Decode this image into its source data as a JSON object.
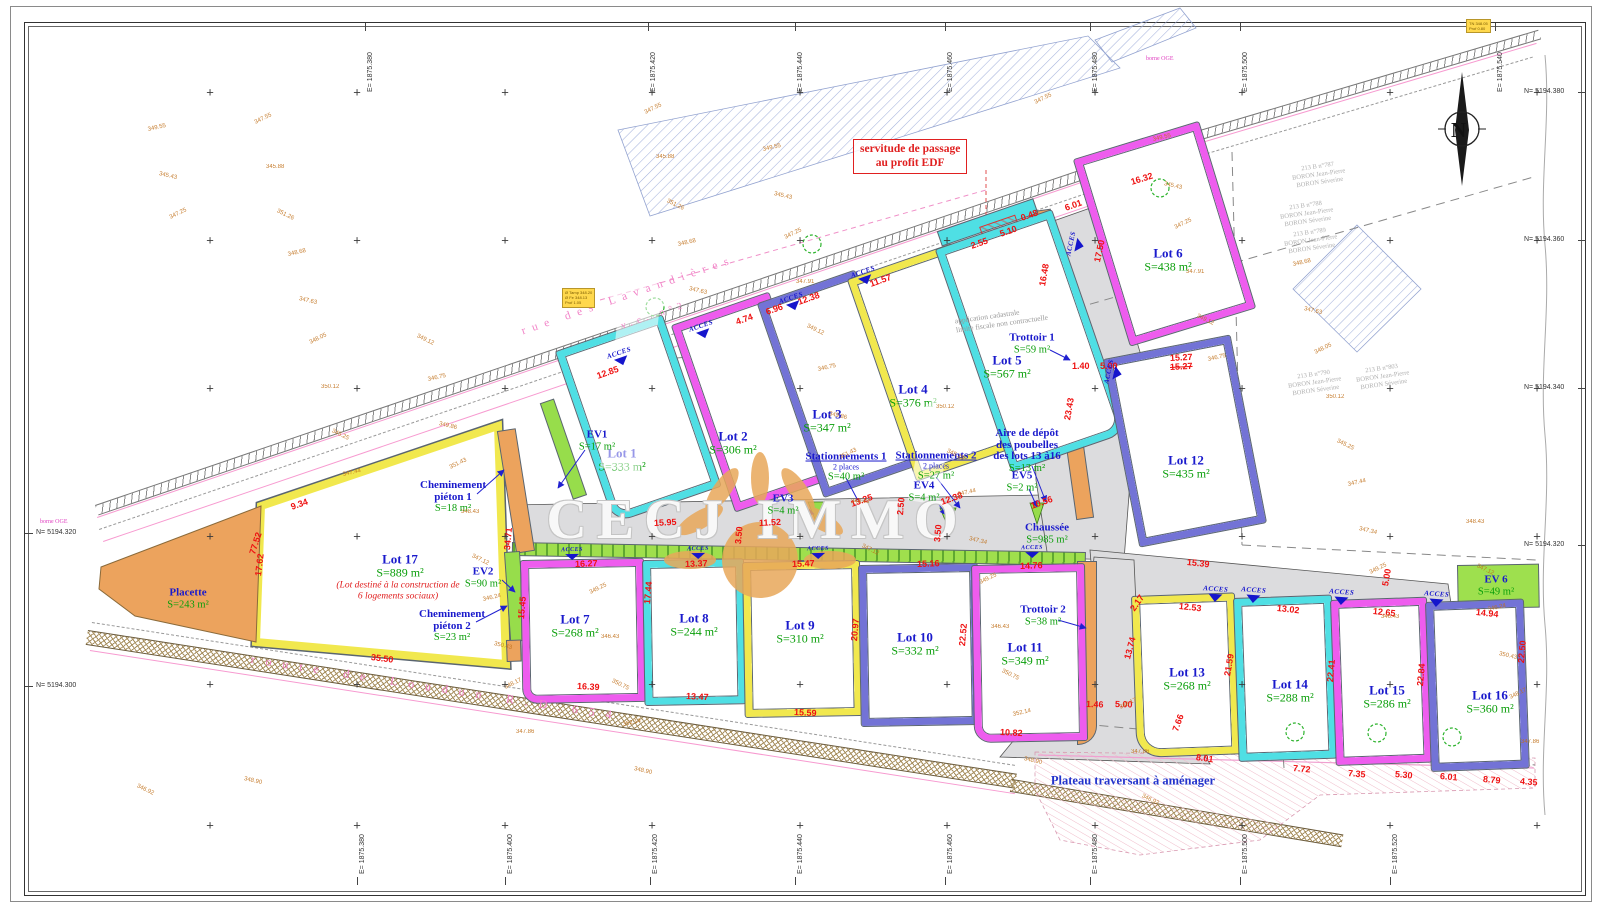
{
  "watermark": "CECJ IMMO",
  "north_letter": "N",
  "colors": {
    "cyan": "#4fdfe4",
    "magenta": "#ee5cee",
    "yellow": "#f1e84e",
    "purple": "#7373d6",
    "green": "#97dd4b",
    "orange": "#eca35d"
  },
  "streets": {
    "top_name": "rue des Lavandières",
    "top_ref": "v.c. n°2",
    "bottom": "route de Loudun R.D.654"
  },
  "annotations": {
    "servitude_l1": "servitude de passage",
    "servitude_l2": "au profit EDF",
    "plateau": "Plateau traversant à aménager",
    "cadastre_l1": "application cadastrale",
    "cadastre_l2": "limite fiscale non contractuelle",
    "borne": "borne OGE",
    "acces": "ACCES",
    "manhole_l1": "Ø Tamp 348.20",
    "manhole_l2": "Ø Fe 348.13",
    "manhole_l3": "Prof 1.05",
    "tn_l1": "TN 348.05",
    "tn_l2": "Prof 0.80"
  },
  "lots": [
    {
      "name": "Lot 1",
      "area": "S=333 m²",
      "c": "cyan",
      "x": 556,
      "y": 352,
      "w": 112,
      "h": 180,
      "r": -19,
      "lx": 622,
      "ly": 460,
      "rad": "2px 2px 2px 18px"
    },
    {
      "name": "Lot 2",
      "area": "S=306 m²",
      "c": "magenta",
      "x": 672,
      "y": 326,
      "w": 102,
      "h": 196,
      "r": -19,
      "lx": 733,
      "ly": 443,
      "rad": "2px"
    },
    {
      "name": "Lot 3",
      "area": "S=347 m²",
      "c": "purple",
      "x": 758,
      "y": 304,
      "w": 102,
      "h": 204,
      "r": -19,
      "lx": 827,
      "ly": 421,
      "rad": "2px"
    },
    {
      "name": "Lot 4",
      "area": "S=376 m²",
      "c": "yellow",
      "x": 848,
      "y": 280,
      "w": 110,
      "h": 212,
      "r": -19,
      "lx": 913,
      "ly": 396,
      "rad": "2px"
    },
    {
      "name": "Lot 5",
      "area": "S=567 m²",
      "c": "cyan",
      "x": 936,
      "y": 250,
      "w": 122,
      "h": 234,
      "r": -19,
      "lx": 1007,
      "ly": 367,
      "rad": "2px 2px 20px 2px"
    },
    {
      "name": "Lot 6",
      "area": "S=438 m²",
      "c": "magenta",
      "x": 1074,
      "y": 160,
      "w": 130,
      "h": 194,
      "r": -17,
      "lx": 1168,
      "ly": 260,
      "rad": "2px"
    },
    {
      "name": "Lot 7",
      "area": "S=268 m²",
      "c": "magenta",
      "x": 521,
      "y": 561,
      "w": 122,
      "h": 142,
      "r": -1,
      "lx": 575,
      "ly": 626,
      "rad": "2px 2px 2px 14px"
    },
    {
      "name": "Lot 8",
      "area": "S=244 m²",
      "c": "cyan",
      "x": 643,
      "y": 561,
      "w": 100,
      "h": 144,
      "r": -1,
      "lx": 694,
      "ly": 625,
      "rad": "2px"
    },
    {
      "name": "Lot 9",
      "area": "S=310 m²",
      "c": "yellow",
      "x": 743,
      "y": 563,
      "w": 116,
      "h": 154,
      "r": -1,
      "lx": 800,
      "ly": 632,
      "rad": "2px"
    },
    {
      "name": "Lot 10",
      "area": "S=332 m²",
      "c": "purple",
      "x": 859,
      "y": 566,
      "w": 118,
      "h": 160,
      "r": -1,
      "lx": 915,
      "ly": 644,
      "rad": "2px"
    },
    {
      "name": "Lot 11",
      "area": "S=349 m²",
      "c": "magenta",
      "x": 972,
      "y": 566,
      "w": 112,
      "h": 176,
      "r": -1,
      "lx": 1025,
      "ly": 654,
      "rad": "2px 2px 2px 16px"
    },
    {
      "name": "Lot 12",
      "area": "S=435 m²",
      "c": "purple",
      "x": 1104,
      "y": 360,
      "w": 128,
      "h": 190,
      "r": -11,
      "lx": 1186,
      "ly": 467,
      "rad": "2px"
    },
    {
      "name": "Lot 13",
      "area": "S=268 m²",
      "c": "yellow",
      "x": 1132,
      "y": 597,
      "w": 102,
      "h": 160,
      "r": -2,
      "lx": 1187,
      "ly": 679,
      "rad": "2px 2px 2px 24px"
    },
    {
      "name": "Lot 14",
      "area": "S=288 m²",
      "c": "cyan",
      "x": 1234,
      "y": 599,
      "w": 97,
      "h": 162,
      "r": -2,
      "lx": 1290,
      "ly": 691,
      "rad": "2px"
    },
    {
      "name": "Lot 15",
      "area": "S=286 m²",
      "c": "magenta",
      "x": 1331,
      "y": 601,
      "w": 95,
      "h": 164,
      "r": -2,
      "lx": 1387,
      "ly": 697,
      "rad": "2px"
    },
    {
      "name": "Lot 16",
      "area": "S=360 m²",
      "c": "purple",
      "x": 1426,
      "y": 603,
      "w": 97,
      "h": 168,
      "r": -2,
      "lx": 1490,
      "ly": 702,
      "rad": "2px"
    }
  ],
  "lot17": {
    "name": "Lot 17",
    "area": "S=889 m²",
    "sub1": "(Lot destiné à la construction de",
    "sub2": "6 logements sociaux)",
    "points": "261,506 498,426 506,664 256,642",
    "lx": 400,
    "ly": 566
  },
  "placette": {
    "points": "101,567 261,506 256,642 135,616 99,589"
  },
  "features": [
    {
      "lines": [
        "Placette"
      ],
      "area": "S=243 m²",
      "x": 188,
      "y": 599
    },
    {
      "lines": [
        "EV1"
      ],
      "area": "S=17 m²",
      "x": 597,
      "y": 441
    },
    {
      "lines": [
        "EV2"
      ],
      "area": "S=90 m²",
      "x": 483,
      "y": 578
    },
    {
      "lines": [
        "EV3"
      ],
      "area": "S=4 m²",
      "x": 783,
      "y": 505
    },
    {
      "lines": [
        "EV4"
      ],
      "area": "S=4 m²",
      "x": 924,
      "y": 492
    },
    {
      "lines": [
        "EV5"
      ],
      "area": "S=2 m²",
      "x": 1022,
      "y": 482
    },
    {
      "lines": [
        "EV 6"
      ],
      "area": "S=49 m²",
      "x": 1496,
      "y": 586
    },
    {
      "lines": [
        "Cheminement",
        "piéton 1"
      ],
      "area": "S=18 m²",
      "x": 453,
      "y": 497
    },
    {
      "lines": [
        "Cheminement",
        "piéton 2"
      ],
      "area": "S=23 m²",
      "x": 452,
      "y": 626
    },
    {
      "lines": [
        "Trottoir 1"
      ],
      "area": "S=59 m²",
      "x": 1032,
      "y": 344
    },
    {
      "lines": [
        "Trottoir 2"
      ],
      "area": "S=38 m²",
      "x": 1043,
      "y": 616
    },
    {
      "lines": [
        "Stationnements 1"
      ],
      "sub": "2 places",
      "area": "S=40 m²",
      "x": 846,
      "y": 467,
      "ul": true
    },
    {
      "lines": [
        "Stationnements 2"
      ],
      "sub": "2 places",
      "area": "S=27 m²",
      "x": 936,
      "y": 466,
      "ul": true
    },
    {
      "lines": [
        "Aire de dépôt",
        "des poubelles",
        "des lots 13 à16"
      ],
      "area": "S=13 m²",
      "x": 1027,
      "y": 451
    },
    {
      "lines": [
        "Chaussée"
      ],
      "area": "S=985 m²",
      "x": 1047,
      "y": 534
    }
  ],
  "dimensions": [
    [
      "12.85",
      597,
      371,
      -19
    ],
    [
      "9.34",
      291,
      502,
      -19
    ],
    [
      "4.74",
      736,
      317,
      -19
    ],
    [
      "6.96",
      766,
      307,
      -19
    ],
    [
      "12.38",
      798,
      297,
      -19
    ],
    [
      "11.57",
      870,
      279,
      -19
    ],
    [
      "16.32",
      1131,
      177,
      -17
    ],
    [
      "6.01",
      1065,
      203,
      -19
    ],
    [
      "0.48",
      1021,
      213,
      -19
    ],
    [
      "5.10",
      1000,
      229,
      -19
    ],
    [
      "2.55",
      971,
      241,
      -19
    ],
    [
      "15.95",
      654,
      518,
      -3
    ],
    [
      "11.52",
      759,
      518,
      -3
    ],
    [
      "13.25",
      851,
      499,
      -19
    ],
    [
      "12.38",
      941,
      497,
      -19
    ],
    [
      "10.56",
      1031,
      501,
      -19
    ],
    [
      "1.40",
      1072,
      361,
      0
    ],
    [
      "5.00",
      1100,
      361,
      0
    ],
    [
      "15.27",
      1170,
      353,
      -3
    ],
    [
      "15.27",
      1170,
      362,
      -3,
      1
    ],
    [
      "17.50",
      1097,
      257,
      -78
    ],
    [
      "16.48",
      1042,
      281,
      -80
    ],
    [
      "23.43",
      1067,
      415,
      -80
    ],
    [
      "34.71",
      507,
      545,
      -85
    ],
    [
      "17.62",
      258,
      571,
      -83
    ],
    [
      "77.52",
      252,
      549,
      -72
    ],
    [
      "16.27",
      575,
      559,
      -2
    ],
    [
      "13.37",
      685,
      559,
      -2
    ],
    [
      "15.47",
      792,
      559,
      -2
    ],
    [
      "15.16",
      917,
      559,
      -2
    ],
    [
      "14.76",
      1020,
      561,
      -2
    ],
    [
      "15.39",
      1187,
      557,
      6
    ],
    [
      "12.53",
      1179,
      601,
      6
    ],
    [
      "13.02",
      1277,
      603,
      6
    ],
    [
      "12.65",
      1373,
      606,
      6
    ],
    [
      "14.94",
      1476,
      607,
      6
    ],
    [
      "5.00",
      1385,
      581,
      -80
    ],
    [
      "16.39",
      577,
      681,
      3
    ],
    [
      "13.47",
      686,
      691,
      3
    ],
    [
      "15.59",
      794,
      707,
      3
    ],
    [
      "10.82",
      1000,
      727,
      3
    ],
    [
      "8.01",
      1196,
      752,
      8
    ],
    [
      "7.66",
      1175,
      726,
      -70
    ],
    [
      "2.17",
      1132,
      605,
      -55
    ],
    [
      "13.74",
      1127,
      654,
      -75
    ],
    [
      "21.59",
      1227,
      671,
      -80
    ],
    [
      "22.41",
      1330,
      677,
      -85
    ],
    [
      "22.84",
      1420,
      681,
      -85
    ],
    [
      "22.50",
      1521,
      658,
      -85
    ],
    [
      "7.35",
      1348,
      768,
      5
    ],
    [
      "5.30",
      1395,
      769,
      5
    ],
    [
      "6.01",
      1440,
      771,
      5
    ],
    [
      "8.79",
      1483,
      774,
      5
    ],
    [
      "4.35",
      1520,
      776,
      5
    ],
    [
      "7.72",
      1293,
      763,
      5
    ],
    [
      "20.97",
      854,
      636,
      -85
    ],
    [
      "22.52",
      962,
      641,
      -85
    ],
    [
      "17.44",
      647,
      599,
      -85
    ],
    [
      "15.45",
      521,
      614,
      -85
    ],
    [
      "3.50",
      738,
      539,
      -85
    ],
    [
      "3.50",
      937,
      537,
      -85
    ],
    [
      "35.50",
      371,
      652,
      7
    ],
    [
      "5.00",
      1115,
      699,
      2
    ],
    [
      "1.46",
      1086,
      699,
      2
    ],
    [
      "2.50",
      900,
      510,
      -85
    ]
  ],
  "elevations": [
    "347.25",
    "347.44",
    "347.86",
    "347.63",
    "347.12",
    "347.55",
    "346.75",
    "346.43",
    "345.43",
    "345.25",
    "348.17",
    "348.68",
    "348.43",
    "348.90",
    "349.12",
    "349.25",
    "349.55",
    "350.12",
    "350.43",
    "351.26",
    "351.43",
    "352.14",
    "347.91",
    "347.34",
    "346.92",
    "348.05",
    "346.24",
    "345.88",
    "349.86",
    "350.75"
  ],
  "parcels": [
    {
      "l1": "213 B n°787",
      "l2": "BORON Jean-Pierre",
      "l3": "BORON Séverine",
      "x": 1292,
      "y": 163
    },
    {
      "l1": "213 B n°788",
      "l2": "BORON Jean-Pierre",
      "l3": "BORON Séverine",
      "x": 1280,
      "y": 202
    },
    {
      "l1": "213 B n°789",
      "l2": "BORON Jean-Pierre",
      "l3": "BORON Séverine",
      "x": 1284,
      "y": 229
    },
    {
      "l1": "213 B n°790",
      "l2": "BORON Jean-Pierre",
      "l3": "BORON Séverine",
      "x": 1288,
      "y": 371
    },
    {
      "l1": "213 B n°803",
      "l2": "BORON Jean-Pierre",
      "l3": "BORON Séverine",
      "x": 1356,
      "y": 365
    }
  ],
  "grid": {
    "top": [
      [
        365,
        "E= 1875.380"
      ],
      [
        648,
        "E= 1875.420"
      ],
      [
        795,
        "E= 1875.440"
      ],
      [
        945,
        "E= 1875.460"
      ],
      [
        1090,
        "E= 1875.480"
      ],
      [
        1240,
        "E= 1875.500"
      ],
      [
        1495,
        "E= 1875.540"
      ]
    ],
    "bottom": [
      [
        357,
        "E= 1875.380"
      ],
      [
        505,
        "E= 1875.400"
      ],
      [
        650,
        "E= 1875.420"
      ],
      [
        795,
        "E= 1875.440"
      ],
      [
        945,
        "E= 1875.460"
      ],
      [
        1090,
        "E= 1875.480"
      ],
      [
        1240,
        "E= 1875.500"
      ],
      [
        1390,
        "E= 1875.520"
      ]
    ],
    "left": [
      [
        533,
        "N= 5194.320"
      ],
      [
        686,
        "N= 5194.300"
      ]
    ],
    "right": [
      [
        92,
        "N= 5194.380"
      ],
      [
        240,
        "N= 5194.360"
      ],
      [
        388,
        "N= 5194.340"
      ],
      [
        545,
        "N= 5194.320"
      ]
    ]
  },
  "acces_points": {
    "road": [
      [
        618,
        350,
        -19
      ],
      [
        700,
        323,
        -19
      ],
      [
        790,
        295,
        -19
      ],
      [
        862,
        269,
        -19
      ]
    ],
    "vert": [
      [
        1068,
        243,
        -78
      ],
      [
        1106,
        371,
        -78
      ]
    ],
    "strip": [
      [
        572,
        547,
        -1
      ],
      [
        698,
        546,
        -1
      ],
      [
        818,
        546,
        -1
      ],
      [
        1032,
        545,
        -1
      ]
    ],
    "branch": [
      [
        1216,
        586,
        4
      ],
      [
        1254,
        587,
        4
      ],
      [
        1342,
        589,
        4
      ],
      [
        1437,
        591,
        4
      ]
    ]
  },
  "leaders": [
    [
      585,
      450,
      558,
      488
    ],
    [
      502,
      580,
      515,
      592
    ],
    [
      477,
      494,
      504,
      470
    ],
    [
      476,
      622,
      507,
      606
    ],
    [
      797,
      508,
      814,
      514
    ],
    [
      934,
      497,
      946,
      515
    ],
    [
      1029,
      489,
      1037,
      507
    ],
    [
      1050,
      350,
      1070,
      360
    ],
    [
      1058,
      620,
      1086,
      628
    ],
    [
      846,
      478,
      864,
      512
    ],
    [
      936,
      477,
      960,
      508
    ],
    [
      1032,
      466,
      1046,
      502
    ]
  ],
  "trees": [
    [
      812,
      244
    ],
    [
      655,
      307
    ],
    [
      1160,
      188
    ],
    [
      1295,
      732
    ],
    [
      1377,
      733
    ],
    [
      1452,
      737
    ]
  ],
  "bornes": [
    [
      40,
      519
    ],
    [
      1146,
      56
    ]
  ]
}
